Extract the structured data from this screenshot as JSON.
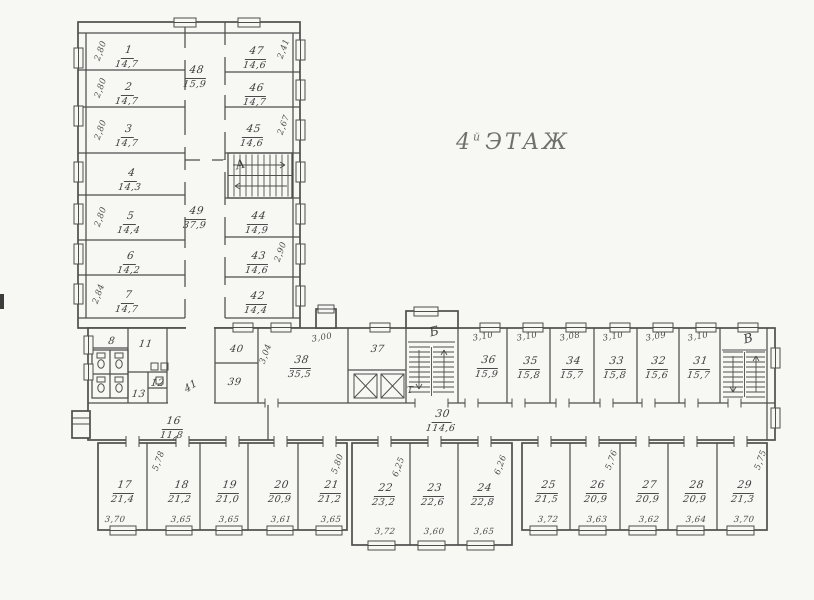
{
  "title": {
    "num": "4",
    "sup": "й",
    "word": "ЭТАЖ"
  },
  "stairs": {
    "a": "А",
    "b": "Б",
    "v": "В",
    "t": "Т"
  },
  "rooms": {
    "r1": {
      "num": "1",
      "area": "14,7",
      "side": "2,80"
    },
    "r2": {
      "num": "2",
      "area": "14,7",
      "side": "2,80"
    },
    "r3": {
      "num": "3",
      "area": "14,7",
      "side": "2,80"
    },
    "r4": {
      "num": "4",
      "area": "14,3"
    },
    "r5": {
      "num": "5",
      "area": "14,4",
      "side": "2,80"
    },
    "r6": {
      "num": "6",
      "area": "14,2"
    },
    "r7": {
      "num": "7",
      "area": "14,7",
      "side": "2,84"
    },
    "r8": {
      "num": "8"
    },
    "r11": {
      "num": "11"
    },
    "r12": {
      "num": "12"
    },
    "r13": {
      "num": "13"
    },
    "r16": {
      "num": "16",
      "area": "11,8"
    },
    "r17": {
      "num": "17",
      "area": "21,4",
      "width": "3,70",
      "depth": "5,78"
    },
    "r18": {
      "num": "18",
      "area": "21,2",
      "width": "3,65"
    },
    "r19": {
      "num": "19",
      "area": "21,0",
      "width": "3,65"
    },
    "r20": {
      "num": "20",
      "area": "20,9",
      "width": "3,61"
    },
    "r21": {
      "num": "21",
      "area": "21,2",
      "width": "3,65",
      "depth": "5,80"
    },
    "r22": {
      "num": "22",
      "area": "23,2",
      "width": "3,72",
      "depth": "6,25"
    },
    "r23": {
      "num": "23",
      "area": "22,6",
      "width": "3,60"
    },
    "r24": {
      "num": "24",
      "area": "22,8",
      "width": "3,65",
      "depth": "6,26"
    },
    "r25": {
      "num": "25",
      "area": "21,5",
      "width": "3,72"
    },
    "r26": {
      "num": "26",
      "area": "20,9",
      "width": "3,63",
      "depth": "5,76"
    },
    "r27": {
      "num": "27",
      "area": "20,9",
      "width": "3,62"
    },
    "r28": {
      "num": "28",
      "area": "20,9",
      "width": "3,64"
    },
    "r29": {
      "num": "29",
      "area": "21,3",
      "width": "3,70",
      "depth": "5,75"
    },
    "r30": {
      "num": "30",
      "area": "114,6"
    },
    "r31": {
      "num": "31",
      "area": "15,7",
      "width": "3,10"
    },
    "r32": {
      "num": "32",
      "area": "15,6",
      "width": "3,09"
    },
    "r33": {
      "num": "33",
      "area": "15,8",
      "width": "3,10"
    },
    "r34": {
      "num": "34",
      "area": "15,7",
      "width": "3,08"
    },
    "r35": {
      "num": "35",
      "area": "15,8",
      "width": "3,10"
    },
    "r36": {
      "num": "36",
      "area": "15,9",
      "width": "3,10"
    },
    "r37": {
      "num": "37"
    },
    "r38": {
      "num": "38",
      "area": "35,5",
      "width": "3,00",
      "depth": "3,04"
    },
    "r39": {
      "num": "39"
    },
    "r40": {
      "num": "40"
    },
    "r41": {
      "num": "41"
    },
    "r42": {
      "num": "42",
      "area": "14,4"
    },
    "r43": {
      "num": "43",
      "area": "14,6",
      "side": "2,90"
    },
    "r44": {
      "num": "44",
      "area": "14,9"
    },
    "r45": {
      "num": "45",
      "area": "14,6",
      "side": "2,67"
    },
    "r46": {
      "num": "46",
      "area": "14,7"
    },
    "r47": {
      "num": "47",
      "area": "14,6",
      "side": "2,41"
    },
    "r48": {
      "num": "48",
      "area": "15,9"
    },
    "r49": {
      "num": "49",
      "area": "37,9"
    }
  }
}
